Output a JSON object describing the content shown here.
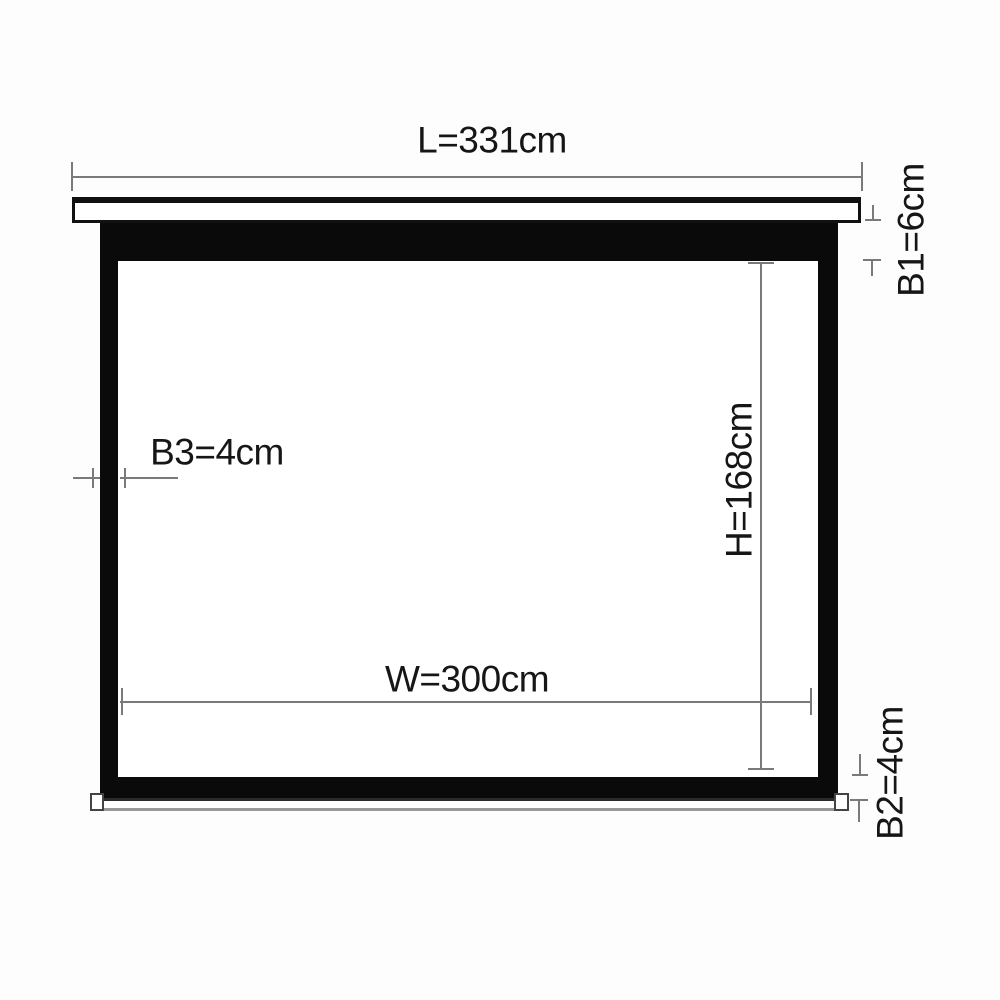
{
  "diagram": {
    "type": "projection-screen-dimension-drawing",
    "unit": "cm",
    "dimensions": {
      "L": {
        "label": "L=331cm",
        "name": "total case length",
        "value": 331,
        "unit": "cm",
        "orientation": "horizontal"
      },
      "B1": {
        "label": "B1=6cm",
        "name": "top black border",
        "value": 6,
        "unit": "cm",
        "orientation": "vertical"
      },
      "B3": {
        "label": "B3=4cm",
        "name": "side black border",
        "value": 4,
        "unit": "cm",
        "orientation": "horizontal"
      },
      "H": {
        "label": "H=168cm",
        "name": "viewing area height",
        "value": 168,
        "unit": "cm",
        "orientation": "vertical"
      },
      "W": {
        "label": "W=300cm",
        "name": "viewing area width",
        "value": 300,
        "unit": "cm",
        "orientation": "horizontal"
      },
      "B2": {
        "label": "B2=4cm",
        "name": "bottom black border",
        "value": 4,
        "unit": "cm",
        "orientation": "vertical"
      }
    }
  },
  "colors": {
    "background": "#fdfdfd",
    "frame": "#0a0a0a",
    "screen": "#ffffff",
    "dimension_line": "#7a7a7a",
    "text": "#161616",
    "outline": "#111111"
  }
}
